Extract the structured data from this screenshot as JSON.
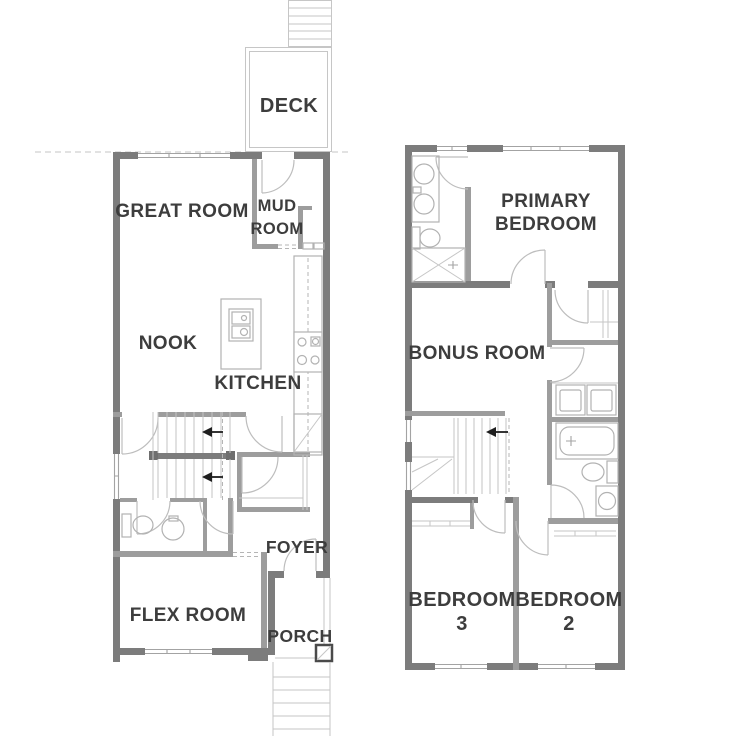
{
  "colors": {
    "background": "#ffffff",
    "wall_dark": "#7c7c7c",
    "wall_medium": "#9d9d9d",
    "fixture_line": "#b2b2b2",
    "light_line": "#c6c6c6",
    "label_text": "#3d3d3d",
    "stair_arrow": "#1e1e1e"
  },
  "floor1": {
    "deck": "DECK",
    "great_room": "GREAT ROOM",
    "mud_room_l1": "MUD",
    "mud_room_l2": "ROOM",
    "nook": "NOOK",
    "kitchen": "KITCHEN",
    "foyer": "FOYER",
    "flex_room": "FLEX ROOM",
    "porch": "PORCH"
  },
  "floor2": {
    "primary_l1": "PRIMARY",
    "primary_l2": "BEDROOM",
    "bonus_room": "BONUS ROOM",
    "bedroom3_l1": "BEDROOM",
    "bedroom3_l2": "3",
    "bedroom2_l1": "BEDROOM",
    "bedroom2_l2": "2"
  }
}
